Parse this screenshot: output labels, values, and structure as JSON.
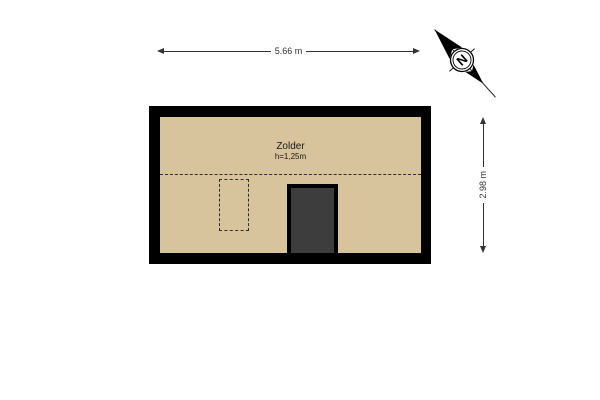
{
  "room": {
    "label": "Zolder",
    "ceiling_height_label": "h=1,25m"
  },
  "dimensions": {
    "width_label": "5.66 m",
    "height_label": "2.98 m"
  },
  "compass": {
    "north_label": "N"
  },
  "colors": {
    "floor": "#d7c39c",
    "wall": "#000000",
    "stairwell_fill": "#3d3d3d",
    "dimension_line": "#333333",
    "background": "#ffffff"
  }
}
